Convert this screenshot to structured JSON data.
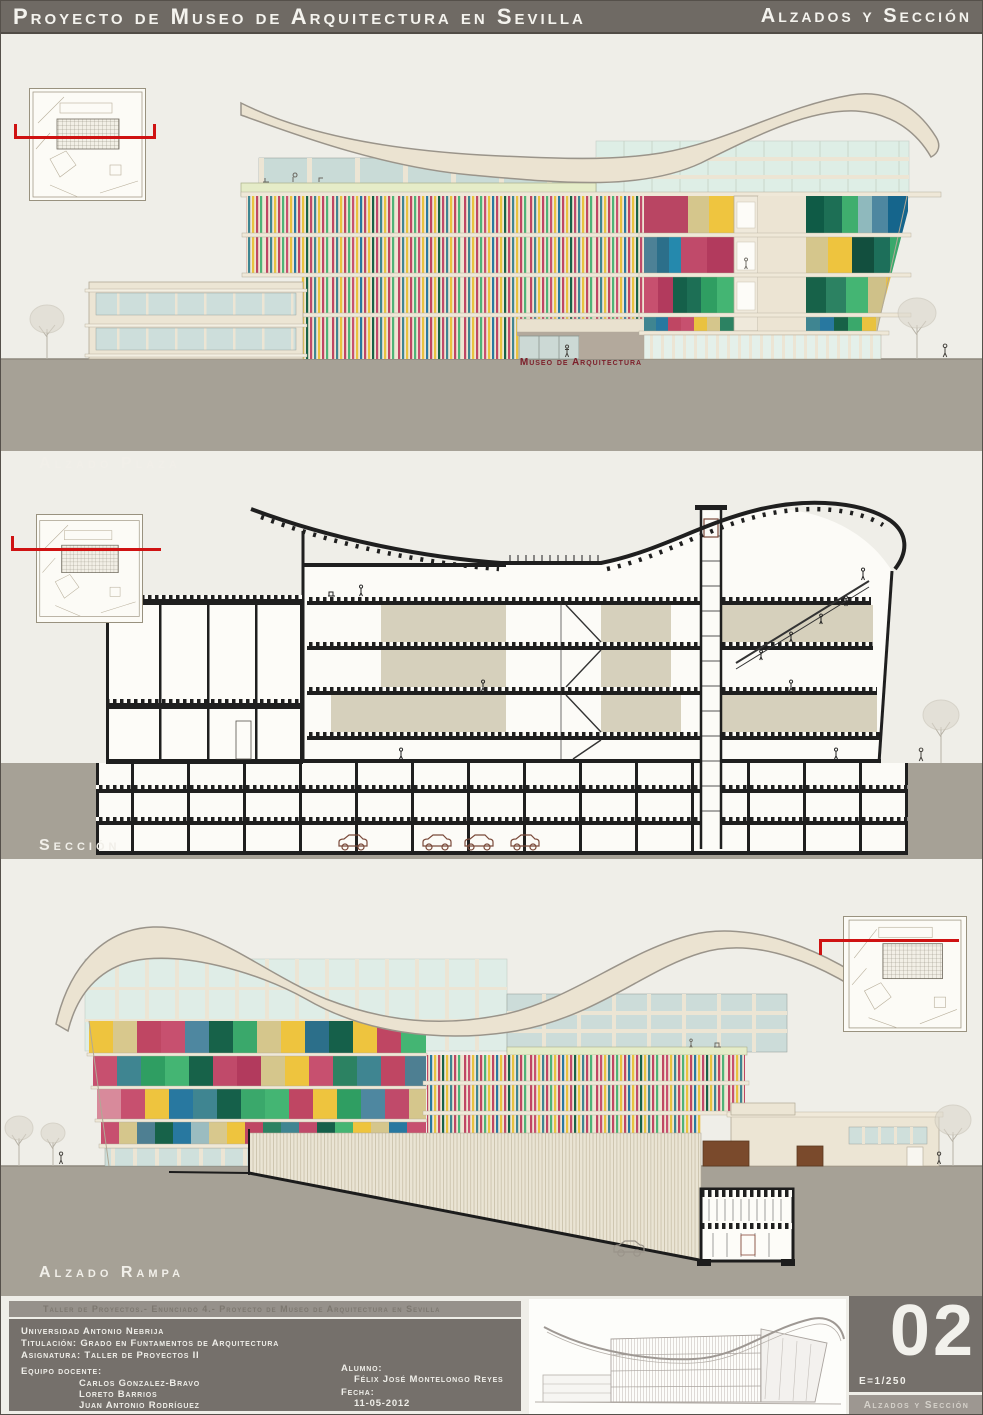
{
  "header": {
    "title": "Proyecto de Museo de Arquitectura en Sevilla",
    "section_label": "Alzados y Sección"
  },
  "panels": {
    "plaza": {
      "label": "Alzado Plaza"
    },
    "seccion": {
      "label": "Sección"
    },
    "rampa": {
      "label": "Alzado Rampa"
    }
  },
  "building": {
    "entrance_sign": "Museo de Arquitectura"
  },
  "footer": {
    "project_strip": "Taller de Proyectos.- Enunciado 4.- Proyecto de Museo de Arquitectura en Sevilla",
    "university": "Universidad Antonio Nebrija",
    "degree": "Titulación: Grado en Funtamentos de Arquitectura",
    "subject": "Asignatura: Taller de Proyectos II",
    "team_label": "Equipo docente:",
    "team": [
      "Carlos Gonzalez-Bravo",
      "Loreto Barrios",
      "Juan Antonio Rodríguez"
    ],
    "student_label": "Alumno:",
    "student": "Félix José Montelongo Reyes",
    "date_label": "Fecha:",
    "date": "11-05-2012",
    "sheet_number": "02",
    "scale": "E=1/250",
    "sheet_caption": "Alzados y Sección"
  },
  "palette": {
    "header_bg": "#6f6a64",
    "panel_bg": "#efeee8",
    "ground": "#a6a196",
    "footer_bg": "#75706b",
    "section_cut_line_red": "#cf1212",
    "entrance_sign_red": "#7c1f2a",
    "facade_crimson": "#bf4663",
    "facade_yellow": "#e9c23f",
    "facade_teal": "#3f8591",
    "facade_green": "#44b573",
    "facade_dark_green": "#15604a",
    "facade_blue": "#2878a0",
    "facade_tan": "#d5c68c",
    "roof_cream": "#ebe3d1",
    "glass_mint": "#deeee6",
    "glass_blue": "#c9dbd7",
    "section_ink": "#1f1f1f",
    "section_olive": "#d6d0bc"
  }
}
